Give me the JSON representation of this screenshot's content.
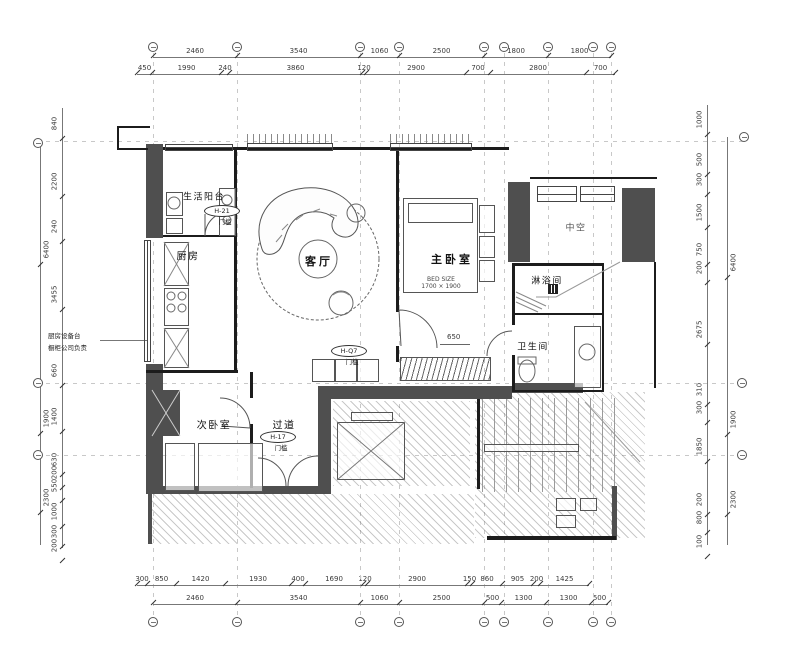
{
  "drawing": {
    "rooms": {
      "balcony": "生活阳台",
      "kitchen": "厨房",
      "living": "客厅",
      "master": "主卧室",
      "shower": "淋浴间",
      "bath": "卫生间",
      "second": "次卧室",
      "corridor": "过道",
      "void": "中空"
    },
    "bed_note": "BED SIZE\n1700 × 1900",
    "door_tags": {
      "t1": {
        "id": "H-21",
        "sub": "门槛"
      },
      "t2": {
        "id": "H-Q7",
        "sub": "门槛"
      },
      "t3": {
        "id": "H-17",
        "sub": "门槛"
      }
    },
    "annotation": {
      "line1": "厨房设备台",
      "line2": "橱柜公司负责"
    },
    "door_dim": "650"
  },
  "dims": {
    "top_row1": [
      "2460",
      "3540",
      "1060",
      "2500",
      "1800",
      "1800"
    ],
    "top_row2": [
      "450",
      "1990",
      "240",
      "3860",
      "120",
      "2900",
      "700",
      "2800",
      "700"
    ],
    "bottom_row1": [
      "300",
      "850",
      "1420",
      "1930",
      "400",
      "1690",
      "120",
      "2900",
      "150",
      "860",
      "905",
      "200",
      "1425"
    ],
    "bottom_row2": [
      "2460",
      "3540",
      "1060",
      "2500",
      "500",
      "1300",
      "1300",
      "500"
    ],
    "left_inner": [
      "840",
      "2200",
      "240",
      "3455",
      "660",
      "1400",
      "630",
      "200",
      "550",
      "1000",
      "300",
      "200"
    ],
    "left_outer": [
      "6400",
      "1900",
      "2300"
    ],
    "right_inner": [
      "1000",
      "500",
      "300",
      "1500",
      "750",
      "200",
      "2675",
      "310",
      "300",
      "1850",
      "200",
      "800",
      "100"
    ],
    "right_outer": [
      "6400",
      "1900",
      "2300"
    ]
  }
}
